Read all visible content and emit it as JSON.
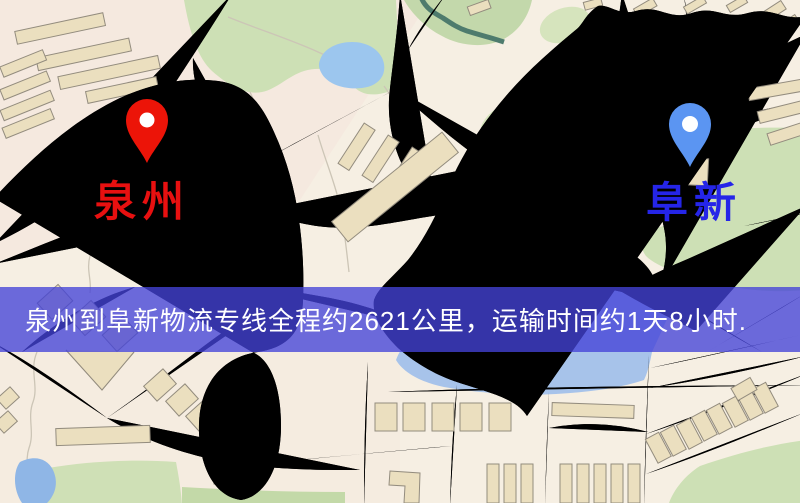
{
  "map": {
    "kind": "street-map",
    "colors": {
      "background": "#f6efe3",
      "road_fill": "#f6d77d",
      "road_border": "#e2b259",
      "building": "#ebdfbf",
      "green_area": "#cde0b5",
      "water": "#9cc6ee",
      "river_lower": "#a7c3ea",
      "railway": "#35353a",
      "contour": "#ccc5b6"
    }
  },
  "pins": {
    "origin": {
      "label": "泉州",
      "pin_color": "#ec1408",
      "label_color": "#e81010",
      "icon": "map-pin-icon"
    },
    "destination": {
      "label": "阜新",
      "pin_color": "#5b95f2",
      "label_color": "#2525e8",
      "icon": "map-pin-icon"
    }
  },
  "banner": {
    "text": "泉州到阜新物流专线全程约2621公里，运输时间约1天8小时.",
    "overlay_color": "#4442d7",
    "text_color": "#ffffff",
    "route": {
      "origin": "泉州",
      "destination": "阜新",
      "distance": "2621公里",
      "duration": "1天8小时"
    }
  }
}
